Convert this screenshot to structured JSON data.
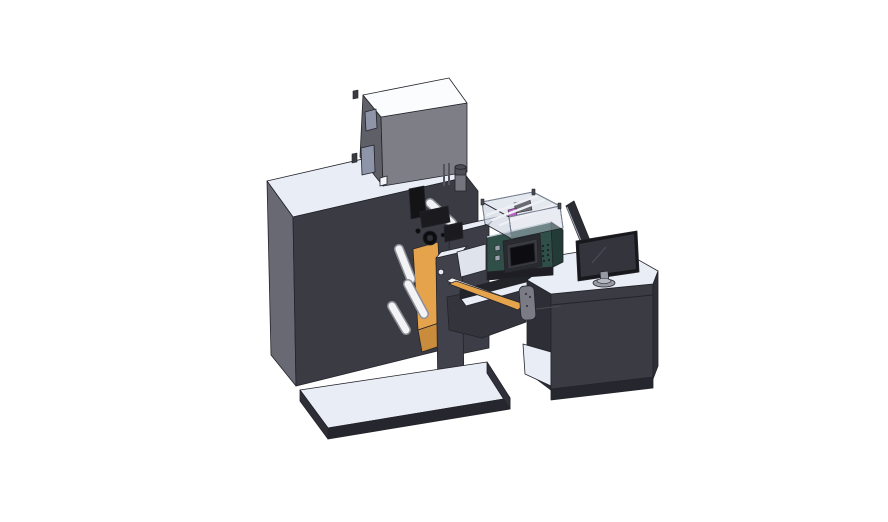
{
  "scene": {
    "type": "3d-cad-render",
    "subject": "label-printing-press-with-coder-and-control-desk",
    "view": "isometric",
    "background": "#ffffff"
  },
  "parts": [
    "machine-main-body",
    "top-cabinet",
    "exhaust-cylinder",
    "web-unwind-mechanism",
    "material-roll",
    "guide-rollers",
    "print-head-assembly",
    "support-column",
    "coder-unit",
    "coder-control-panel",
    "transparent-guard",
    "outfeed-deck",
    "sensor-bracket",
    "base-platform",
    "control-desk",
    "desk-monitor",
    "side-glass-panel"
  ],
  "colors": {
    "background": "#ffffff",
    "surface_light": "#e9edf5",
    "box_top_white": "#fbfcfe",
    "face_front_dark": "#3b3b44",
    "face_side_medium": "#696974",
    "face_side_dark": "#2e2e37",
    "edge_dark": "#26262e",
    "platform_right": "#30303a",
    "box_front": "#7e7e87",
    "box_side": "#5f5f68",
    "window_glass": "#8e95a8",
    "detail_dark": "#55555e",
    "tab_dark": "#3a3a42",
    "label_white": "#f4f5f8",
    "cylinder_body": "#75757e",
    "cylinder_cap": "#4d4d56",
    "right_block": "#3d3d47",
    "column": "#41414b",
    "orange": "#e5a34c",
    "orange_dark": "#c98c3c",
    "black_part": "#141417",
    "black_part2": "#1b1b1f",
    "gear_dark": "#0d0d10",
    "gear_mid": "#303038",
    "dot_white": "#eaeaf0",
    "under_dark": "#34343d",
    "beam_dark": "#23232a",
    "roller_white": "#f3f3f6",
    "roller_shadow": "#8e8e97",
    "deck_light": "#dfe3ec",
    "teal_front": "#2f4f48",
    "teal_side": "#223b36",
    "teal_trim": "#c7ced8",
    "teal_under": "#1e1e24",
    "button_light": "#9aa0ac",
    "panel_body": "#2a2a31",
    "panel_ring": "#3a3a41",
    "panel_screen": "#0d0d11",
    "screen_frame": "#5b5b64",
    "vent_dark": "#17231f",
    "glass_fill": "#c9d1df",
    "glass_frame": "#7b8494",
    "glass_post": "#4a4a52",
    "rail_white": "#eef0f5",
    "inner_gray": "#6a6a74",
    "magenta": "#bb5fc4",
    "sensor_gray": "#7b7b85",
    "sensor_dot": "#3a3a40",
    "wire": "#4a4a52",
    "side_panel": "#2c2c34",
    "panel_highlight": "#98a0ad",
    "monitor_bezel": "#17171c",
    "monitor_screen": "#34343c",
    "monitor_glare": "#4a4a55",
    "stand_gray": "#979aa4",
    "stand_dark": "#5f626b",
    "stand_top": "#b6b9c2",
    "seam": "#24242b"
  }
}
